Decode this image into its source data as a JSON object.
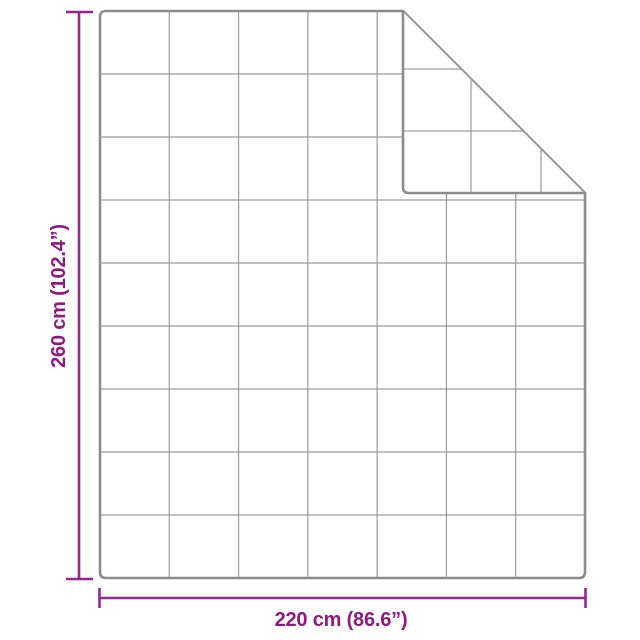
{
  "diagram": {
    "type": "product-dimension-diagram",
    "subject": "quilted-blanket-with-folded-corner",
    "grid_rows": 9,
    "grid_columns": 7,
    "outline_color": "#8c8c8c",
    "grid_color": "#9a9a9a",
    "fold_edge_color": "#9a9a9a",
    "fill_color": "#ffffff",
    "background_color": "#ffffff"
  },
  "dimensions": {
    "line_color": "#93278b",
    "label_color": "#8d1a7d",
    "height": {
      "label": "260 cm (102.4”)"
    },
    "width": {
      "label": "220 cm (86.6”)"
    }
  }
}
